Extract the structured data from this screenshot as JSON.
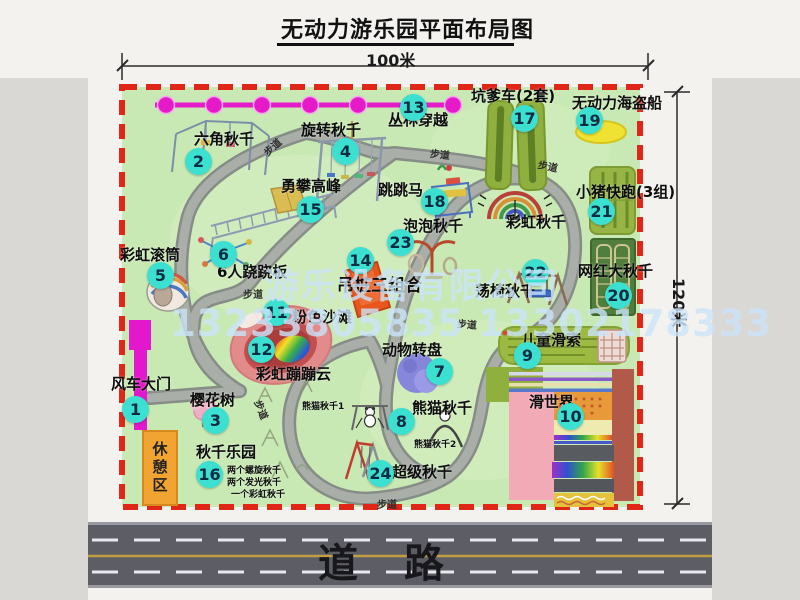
{
  "title": "无动力游乐园平面布局图",
  "dimensions": {
    "width_label": "100米",
    "height_label": "120米"
  },
  "road_label": "道路",
  "trail_label": "步道",
  "rest_area_label": "休憩区",
  "rainbow_swing_label": "彩虹秋千",
  "panda_swing_sub1": "熊猫秋千1",
  "panda_swing_sub2": "熊猫秋千2",
  "swing_park_notes": [
    "两个螺旋秋千",
    "两个发光秋千",
    "一个彩虹秋千"
  ],
  "watermark": {
    "company": "游乐设备有限公司",
    "phone": "13233805835 13302178333"
  },
  "attractions": [
    {
      "num": "1",
      "label": "风车大门"
    },
    {
      "num": "2",
      "label": "六角秋千"
    },
    {
      "num": "3",
      "label": "樱花树"
    },
    {
      "num": "4",
      "label": "旋转秋千"
    },
    {
      "num": "5",
      "label": "彩虹滚筒"
    },
    {
      "num": "6",
      "label": "6人跷跷板"
    },
    {
      "num": "7",
      "label": "动物转盘"
    },
    {
      "num": "8",
      "label": "熊猫秋千"
    },
    {
      "num": "9",
      "label": "儿童滑索"
    },
    {
      "num": "10",
      "label": "滑世界"
    },
    {
      "num": "11",
      "label": "粉色沙滩"
    },
    {
      "num": "12",
      "label": "彩虹蹦蹦云"
    },
    {
      "num": "13",
      "label": "丛林穿越"
    },
    {
      "num": "14",
      "label": "吊桩三组合"
    },
    {
      "num": "15",
      "label": "勇攀高峰"
    },
    {
      "num": "16",
      "label": "秋千乐园"
    },
    {
      "num": "17",
      "label": "坑爹车(2套)"
    },
    {
      "num": "18",
      "label": "跳跳马"
    },
    {
      "num": "19",
      "label": "无动力海盗船"
    },
    {
      "num": "20",
      "label": "网红大秋千"
    },
    {
      "num": "21",
      "label": "小猪快跑(3组)"
    },
    {
      "num": "22",
      "label": "荡椅秋千"
    },
    {
      "num": "23",
      "label": "泡泡秋千"
    },
    {
      "num": "24",
      "label": "超级秋千"
    }
  ],
  "colors": {
    "map_green": "#c9e9b4",
    "path_gray": "#a9afa8",
    "border_red": "#e02616",
    "zipline_magenta": "#e51ac8",
    "number_circle_cyan": "#3ce0d1",
    "road_gray": "#5d5d66",
    "road_center_yellow": "#bf9f42",
    "rest_area_orange": "#f2a432",
    "gate_magenta": "#e317cb",
    "watermark_blue": "#cae3f9"
  }
}
